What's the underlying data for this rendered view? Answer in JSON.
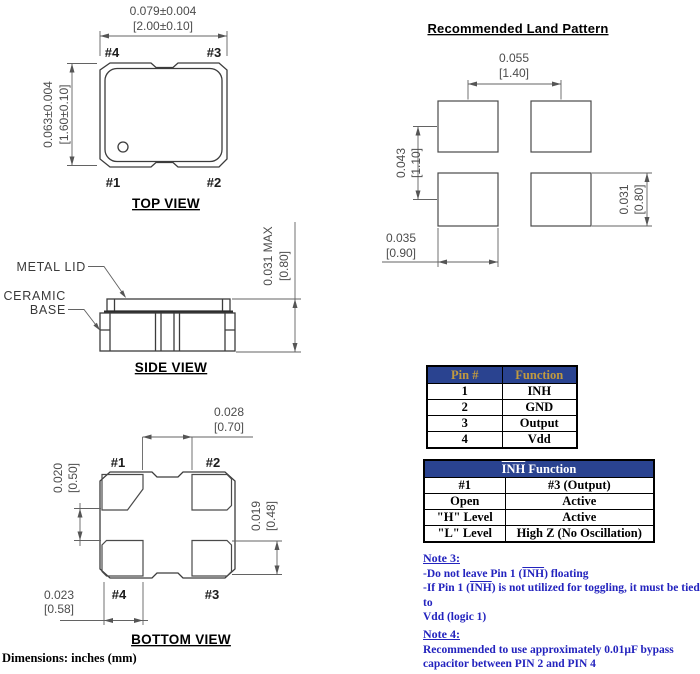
{
  "top_view": {
    "title": "TOP VIEW",
    "dim_width_in": "0.079±0.004",
    "dim_width_mm": "[2.00±0.10]",
    "dim_height_in": "0.063±0.004",
    "dim_height_mm": "[1.60±0.10]",
    "pin1": "#1",
    "pin2": "#2",
    "pin3": "#3",
    "pin4": "#4"
  },
  "land_pattern": {
    "title": "Recommended Land Pattern",
    "dim_h_pitch_in": "0.055",
    "dim_h_pitch_mm": "[1.40]",
    "dim_v_pitch_in": "0.043",
    "dim_v_pitch_mm": "[1.10]",
    "dim_pad_height_in": "0.031",
    "dim_pad_height_mm": "[0.80]",
    "dim_pad_width_in": "0.035",
    "dim_pad_width_mm": "[0.90]"
  },
  "side_view": {
    "title": "SIDE VIEW",
    "label_metal_lid": "METAL LID",
    "label_ceramic": "CERAMIC",
    "label_base": "BASE",
    "dim_height_in": "0.031  MAX",
    "dim_height_mm": "[0.80]"
  },
  "bottom_view": {
    "title": "BOTTOM VIEW",
    "pin1": "#1",
    "pin2": "#2",
    "pin3": "#3",
    "pin4": "#4",
    "dim_pad_gap_in": "0.028",
    "dim_pad_gap_mm": "[0.70]",
    "dim_row_gap_in": "0.020",
    "dim_row_gap_mm": "[0.50]",
    "dim_pad_height_in": "0.019",
    "dim_pad_height_mm": "[0.48]",
    "dim_pad_width_in": "0.023",
    "dim_pad_width_mm": "[0.58]"
  },
  "pin_table": {
    "header_pin": "Pin #",
    "header_function": "Function",
    "rows": [
      {
        "pin": "1",
        "function": "INH"
      },
      {
        "pin": "2",
        "function": "GND"
      },
      {
        "pin": "3",
        "function": "Output"
      },
      {
        "pin": "4",
        "function": "Vdd"
      }
    ]
  },
  "inh_table": {
    "header_inh": "INH",
    "header_rest": " Function",
    "rows": [
      {
        "c1": "#1",
        "c2": "#3 (Output)"
      },
      {
        "c1": "Open",
        "c2": "Active"
      },
      {
        "c1": "\"H\" Level",
        "c2": "Active"
      },
      {
        "c1": "\"L\" Level",
        "c2": "High Z (No Oscillation)"
      }
    ]
  },
  "notes": {
    "note3": {
      "heading": "Note 3:",
      "l1_pre": "-Do not leave Pin 1 (",
      "l1_inh": "INH",
      "l1_post": ") floating",
      "l2_pre": "-If Pin 1 (",
      "l2_inh": "INH",
      "l2_post": ") is not utilized for toggling, it must be tied to",
      "l3": "Vdd (logic 1)"
    },
    "note4": {
      "heading": "Note 4:",
      "l1": "Recommended to use approximately 0.01µF bypass",
      "l2": "capacitor between PIN 2 and PIN 4"
    }
  },
  "footer": {
    "dimensions_note": "Dimensions: inches (mm)"
  },
  "colors": {
    "table_header_bg": "#2A4390",
    "pin_table_header_text": "#C19A3F",
    "inh_table_header_text": "#FFFFFF",
    "note_text": "#2323BE",
    "drawing_line": "#3C3C3C",
    "dimension_text": "#4C4C4C"
  }
}
